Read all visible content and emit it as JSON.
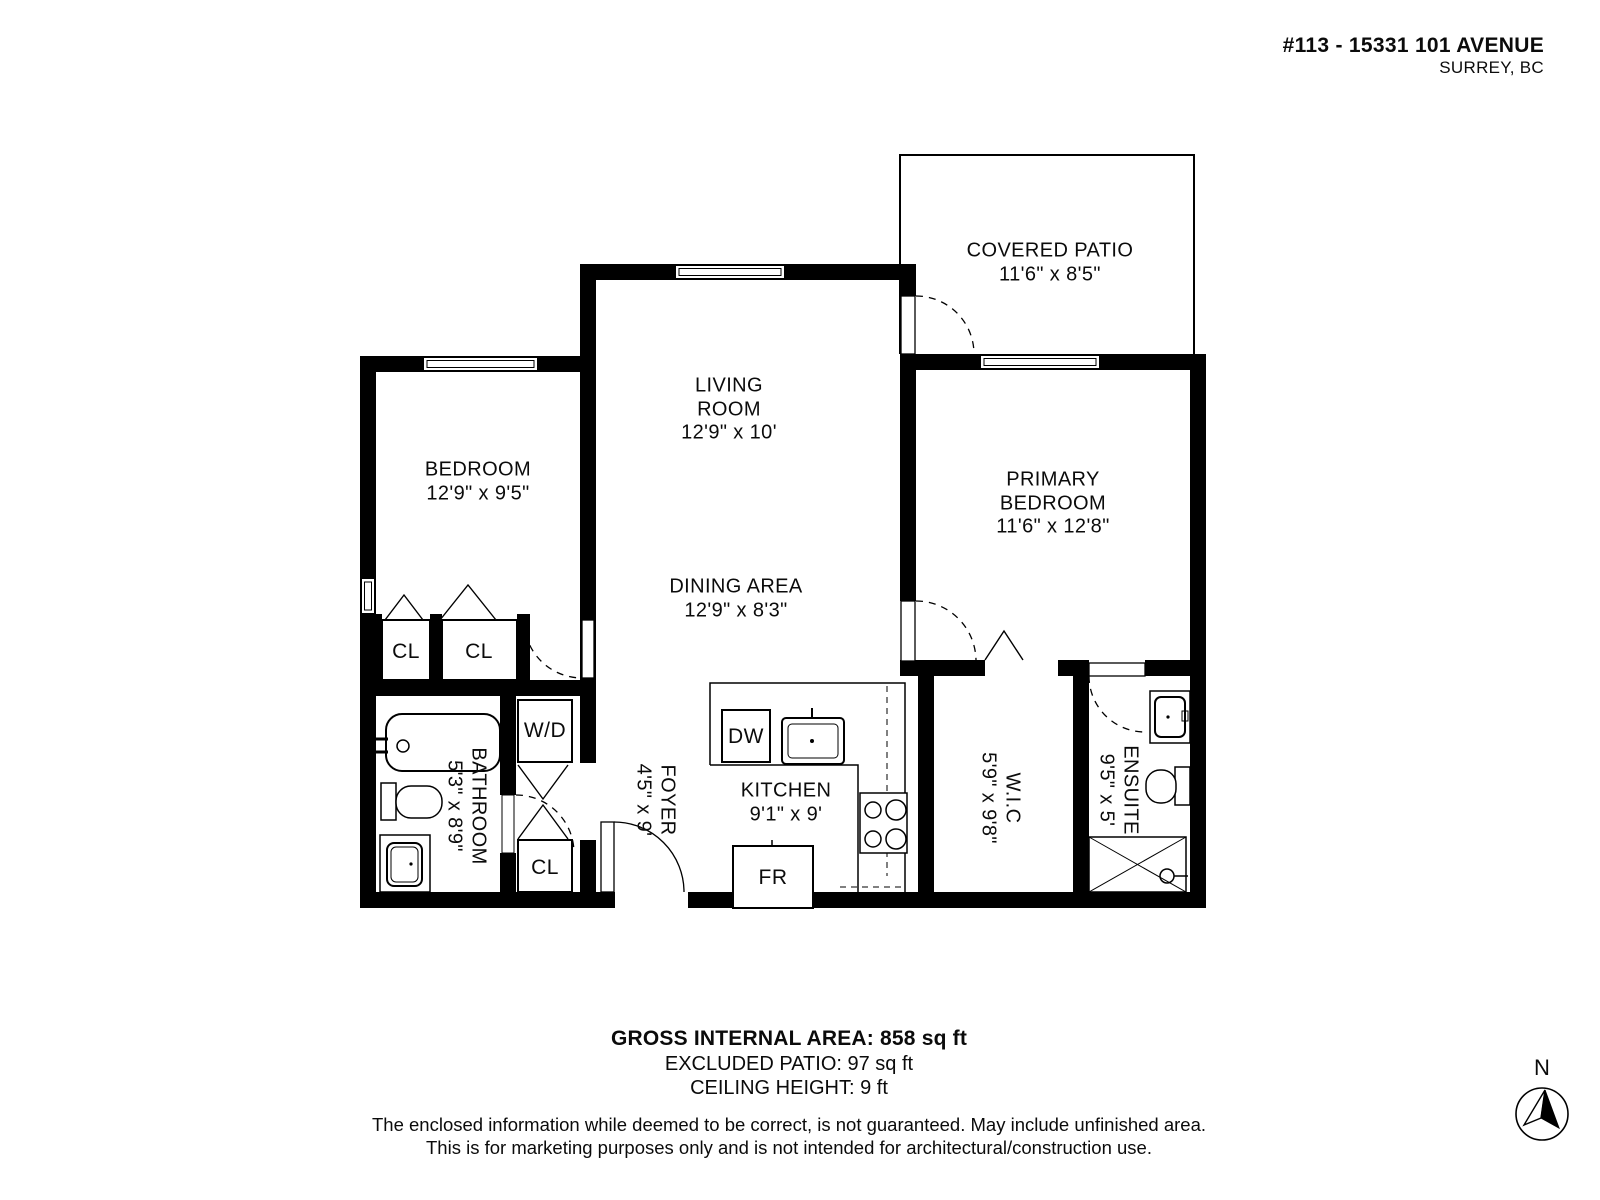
{
  "header": {
    "address_line1": "#113 - 15331 101 AVENUE",
    "address_line2": "SURREY, BC"
  },
  "rooms": {
    "covered_patio": {
      "name": "COVERED PATIO",
      "dims": "11'6\" x 8'5\""
    },
    "living_room": {
      "name": "LIVING ROOM",
      "dims": "12'9\" x 10'"
    },
    "bedroom": {
      "name": "BEDROOM",
      "dims": "12'9\" x 9'5\""
    },
    "primary_bedroom": {
      "name": "PRIMARY BEDROOM",
      "dims": "11'6\" x 12'8\""
    },
    "dining_area": {
      "name": "DINING AREA",
      "dims": "12'9\" x 8'3\""
    },
    "kitchen": {
      "name": "KITCHEN",
      "dims": "9'1\" x 9'"
    },
    "foyer": {
      "name": "FOYER",
      "dims": "4'5\" x 9'"
    },
    "bathroom": {
      "name": "BATHROOM",
      "dims": "5'3\" x 8'9\""
    },
    "wic": {
      "name": "W.I.C",
      "dims": "5'9\" x 9'8\""
    },
    "ensuite": {
      "name": "ENSUITE",
      "dims": "9'5\" x 5'"
    }
  },
  "labels": {
    "closet": "CL",
    "washer_dryer": "W/D",
    "dishwasher": "DW",
    "fridge": "FR"
  },
  "footer": {
    "area_line": "GROSS INTERNAL AREA: 858 sq ft",
    "patio_line": "EXCLUDED PATIO: 97 sq ft",
    "ceiling_line": "CEILING HEIGHT: 9 ft",
    "disclaimer_line1": "The enclosed information while deemed to be correct, is not guaranteed. May include unfinished area.",
    "disclaimer_line2": "This is for marketing purposes only and is not intended for architectural/construction use."
  },
  "compass": {
    "north_label": "N"
  }
}
